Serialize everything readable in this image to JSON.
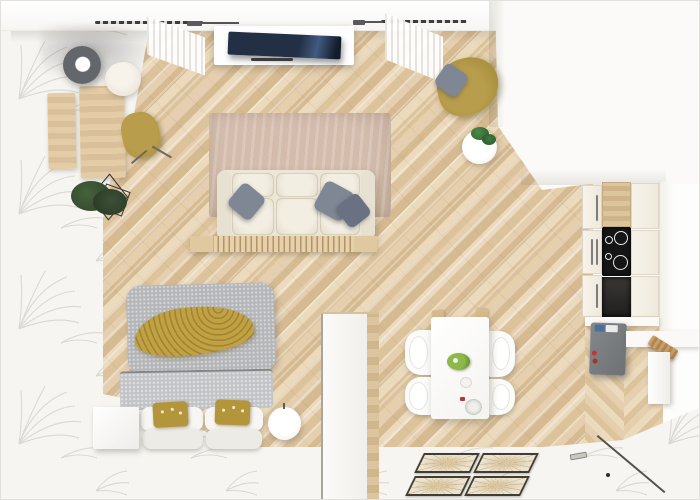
{
  "scene": {
    "kind": "3d-floorplan-render",
    "view": "top-down",
    "space": "studio-apartment",
    "zones": [
      "workspace",
      "living-room",
      "reading-corner",
      "bedroom",
      "dining-area",
      "kitchen",
      "entryway"
    ]
  },
  "colors": {
    "wood_light": "#ecdabd",
    "wood_mid": "#e5cfae",
    "wood_dark": "#dcc39c",
    "wood_deep": "#d5ba92",
    "desk_wood": "#e4cca6",
    "cream": "#ebe6d8",
    "rug_beige": "#cbb4a3",
    "olive": "#a8913f",
    "olive_light": "#b89d4c",
    "mustard": "#c0a143",
    "mustard_dark": "#b3953c",
    "bed_gray": "#b5b6b9",
    "bed_gray_light": "#c3c4c7",
    "pillow_gray": "#7f8795",
    "pillow_gray_dark": "#6a7182",
    "tv_navy": "#232f45",
    "cooktop_black": "#151515",
    "fridge_gray": "#797d80",
    "wall_white": "#f9f8f6",
    "rug_white": "#f6f5f2",
    "leaf_stroke": "#dbd8d1",
    "plant_green": "#3d5137",
    "monstera_green": "#3f7a3f",
    "tile_border": "#413d32",
    "tile_fill": "#ece4d1"
  },
  "furniture": {
    "workspace": [
      "desk",
      "desk-bench",
      "desk-chair-olive",
      "floor-lamp-gray",
      "table-lamp-beige",
      "potted-plant-geometric-stand"
    ],
    "living": [
      "tv-flatscreen",
      "media-console",
      "window-curtain-left",
      "window-curtain-right",
      "curtain-rod-left",
      "curtain-rod-right",
      "sofa-3-seat-cream",
      "gray-throw-pillows-x3",
      "area-rug-beige",
      "slatted-coffee-bench"
    ],
    "reading": [
      "armchair-olive",
      "gray-pillow",
      "round-side-table",
      "monstera-plant"
    ],
    "bedroom": [
      "double-bed",
      "gray-duvet",
      "mustard-throw-blanket",
      "white-pillows-x4",
      "mustard-pillows-x2",
      "nightstand-cube",
      "round-pouf",
      "partition-wardrobe"
    ],
    "dining": [
      "dining-table-white",
      "dining-chairs-x4",
      "fruit-plate-green",
      "small-bowl",
      "drinking-glass"
    ],
    "kitchen": [
      "cabinet-doors-left-x3",
      "cabinet-doors-right-x3",
      "wood-counter-section",
      "induction-cooktop-4-zones",
      "oven-niche",
      "tall-gray-cabinet",
      "red-bottles",
      "right-counter",
      "cutting-board",
      "white-shelf"
    ],
    "entry": [
      "door-track-line",
      "door-handle",
      "door-stop-dot",
      "decorative-floor-tiles-x4"
    ]
  },
  "counts": {
    "sofa_pillows": 3,
    "dining_chairs": 4,
    "cooktop_rings": 4,
    "deco_tiles": 4,
    "bed_mustard_pillows": 2
  }
}
